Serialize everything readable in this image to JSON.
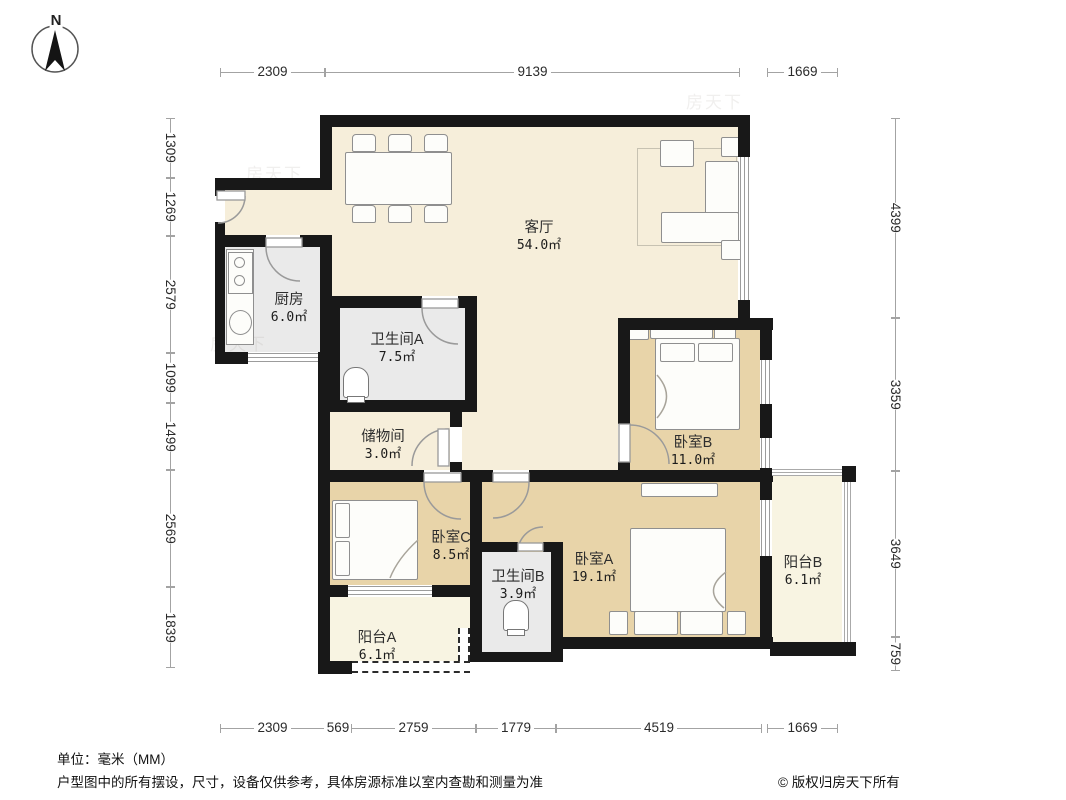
{
  "compass": {
    "label": "N"
  },
  "dims": {
    "top": [
      "2309",
      "9139",
      "1669"
    ],
    "bottom": [
      "2309",
      "569",
      "2759",
      "1779",
      "4519",
      "1669"
    ],
    "left": [
      "1309",
      "1269",
      "2579",
      "1099",
      "1499",
      "2569",
      "1839"
    ],
    "right": [
      "4399",
      "3359",
      "3649",
      "759"
    ]
  },
  "rooms": {
    "living": {
      "name": "客厅",
      "area": "54.0㎡"
    },
    "kitchen": {
      "name": "厨房",
      "area": "6.0㎡"
    },
    "bath_a": {
      "name": "卫生间A",
      "area": "7.5㎡"
    },
    "storage": {
      "name": "储物间",
      "area": "3.0㎡"
    },
    "bedroom_b": {
      "name": "卧室B",
      "area": "11.0㎡"
    },
    "bedroom_c": {
      "name": "卧室C",
      "area": "8.5㎡"
    },
    "bath_b": {
      "name": "卫生间B",
      "area": "3.9㎡"
    },
    "bedroom_a": {
      "name": "卧室A",
      "area": "19.1㎡"
    },
    "balcony_b": {
      "name": "阳台B",
      "area": "6.1㎡"
    },
    "balcony_a": {
      "name": "阳台A",
      "area": "6.1㎡"
    }
  },
  "footer": {
    "unit": "单位：毫米（MM）",
    "disclaimer": "户型图中的所有摆设，尺寸，设备仅供参考，具体房源标准以室内查勘和测量为准",
    "copyright": "© 版权归房天下所有"
  },
  "watermark": "房天下",
  "colors": {
    "wall": "#181818",
    "living_floor": "#f6eeda",
    "bedroom_floor": "#e8d4a9",
    "wet_floor": "#eaeaea",
    "balcony_floor": "#f8f4e2",
    "dim_line": "#a3a3a3"
  }
}
